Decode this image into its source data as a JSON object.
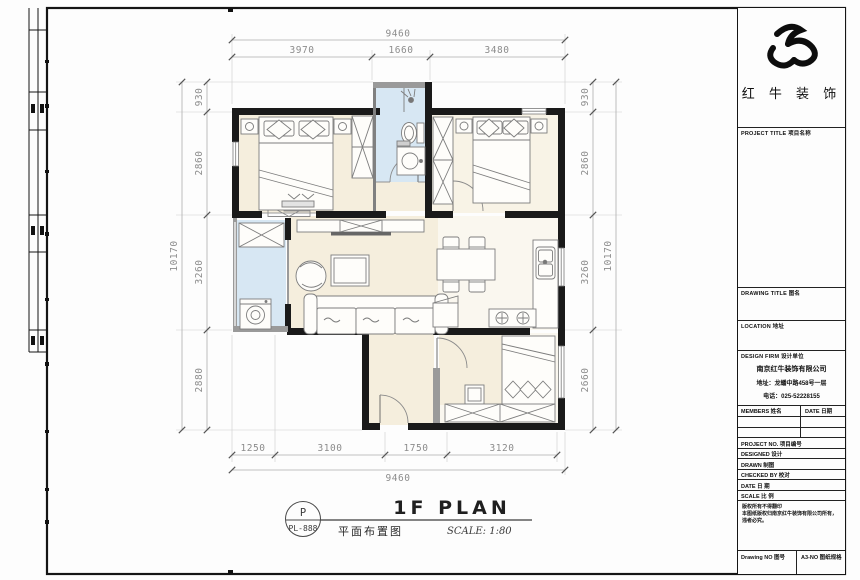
{
  "titleblock": {
    "brand_name": "红 牛 装 饰",
    "project_title": "PROJECT TITLE  项目名称",
    "drawing_title": "DRAWING TITLE  图名",
    "location": "LOCATION  地址",
    "design_firm": "DESIGN FIRM  设计单位",
    "company": "南京红牛装饰有限公司",
    "address": "地址：龙蟠中路458号一层",
    "phone": "电话：025-52228155",
    "members_col": "MEMBERS  姓名",
    "date_col": "DATE  日期",
    "rows": [
      "PROJECT NO.  项目编号",
      "DESIGNED  设计",
      "DRAWN  制图",
      "CHECKED BY  校对",
      "DATE  日 期",
      "SCALE  比 例"
    ],
    "disclaimer": [
      "版权所有不得翻印",
      "本图纸版权归南京红牛装饰有限公司所有，",
      "违者必究。"
    ],
    "drawing_no": "Drawing NO  图号",
    "sheet_no": "A3-NO  图纸规格"
  },
  "dims": {
    "top": {
      "total": "9460",
      "parts": [
        "3970",
        "1660",
        "3480"
      ]
    },
    "bottom": {
      "total": "9460",
      "parts": [
        "1250",
        "3100",
        "1750",
        "3120"
      ]
    },
    "left": {
      "total": "10170",
      "parts": [
        "930",
        "2860",
        "3260",
        "2880"
      ]
    },
    "right": {
      "total": "10170",
      "parts": [
        "930",
        "2860",
        "3260",
        "2660"
      ]
    }
  },
  "caption": {
    "tag_letter": "P",
    "tag_code": "PL-888",
    "title_en": "1F PLAN",
    "title_cn": "平面布置图",
    "scale": "SCALE: 1:80"
  },
  "colors": {
    "wall": "#1a1a1a",
    "wall_gray": "#9a9a9a",
    "floor_warm": "#f5eedd",
    "floor_light": "#faf7ef",
    "floor_wet": "#d7e7f3",
    "dim_line": "#b5b5b5",
    "dim_text": "#8c8c8c"
  }
}
